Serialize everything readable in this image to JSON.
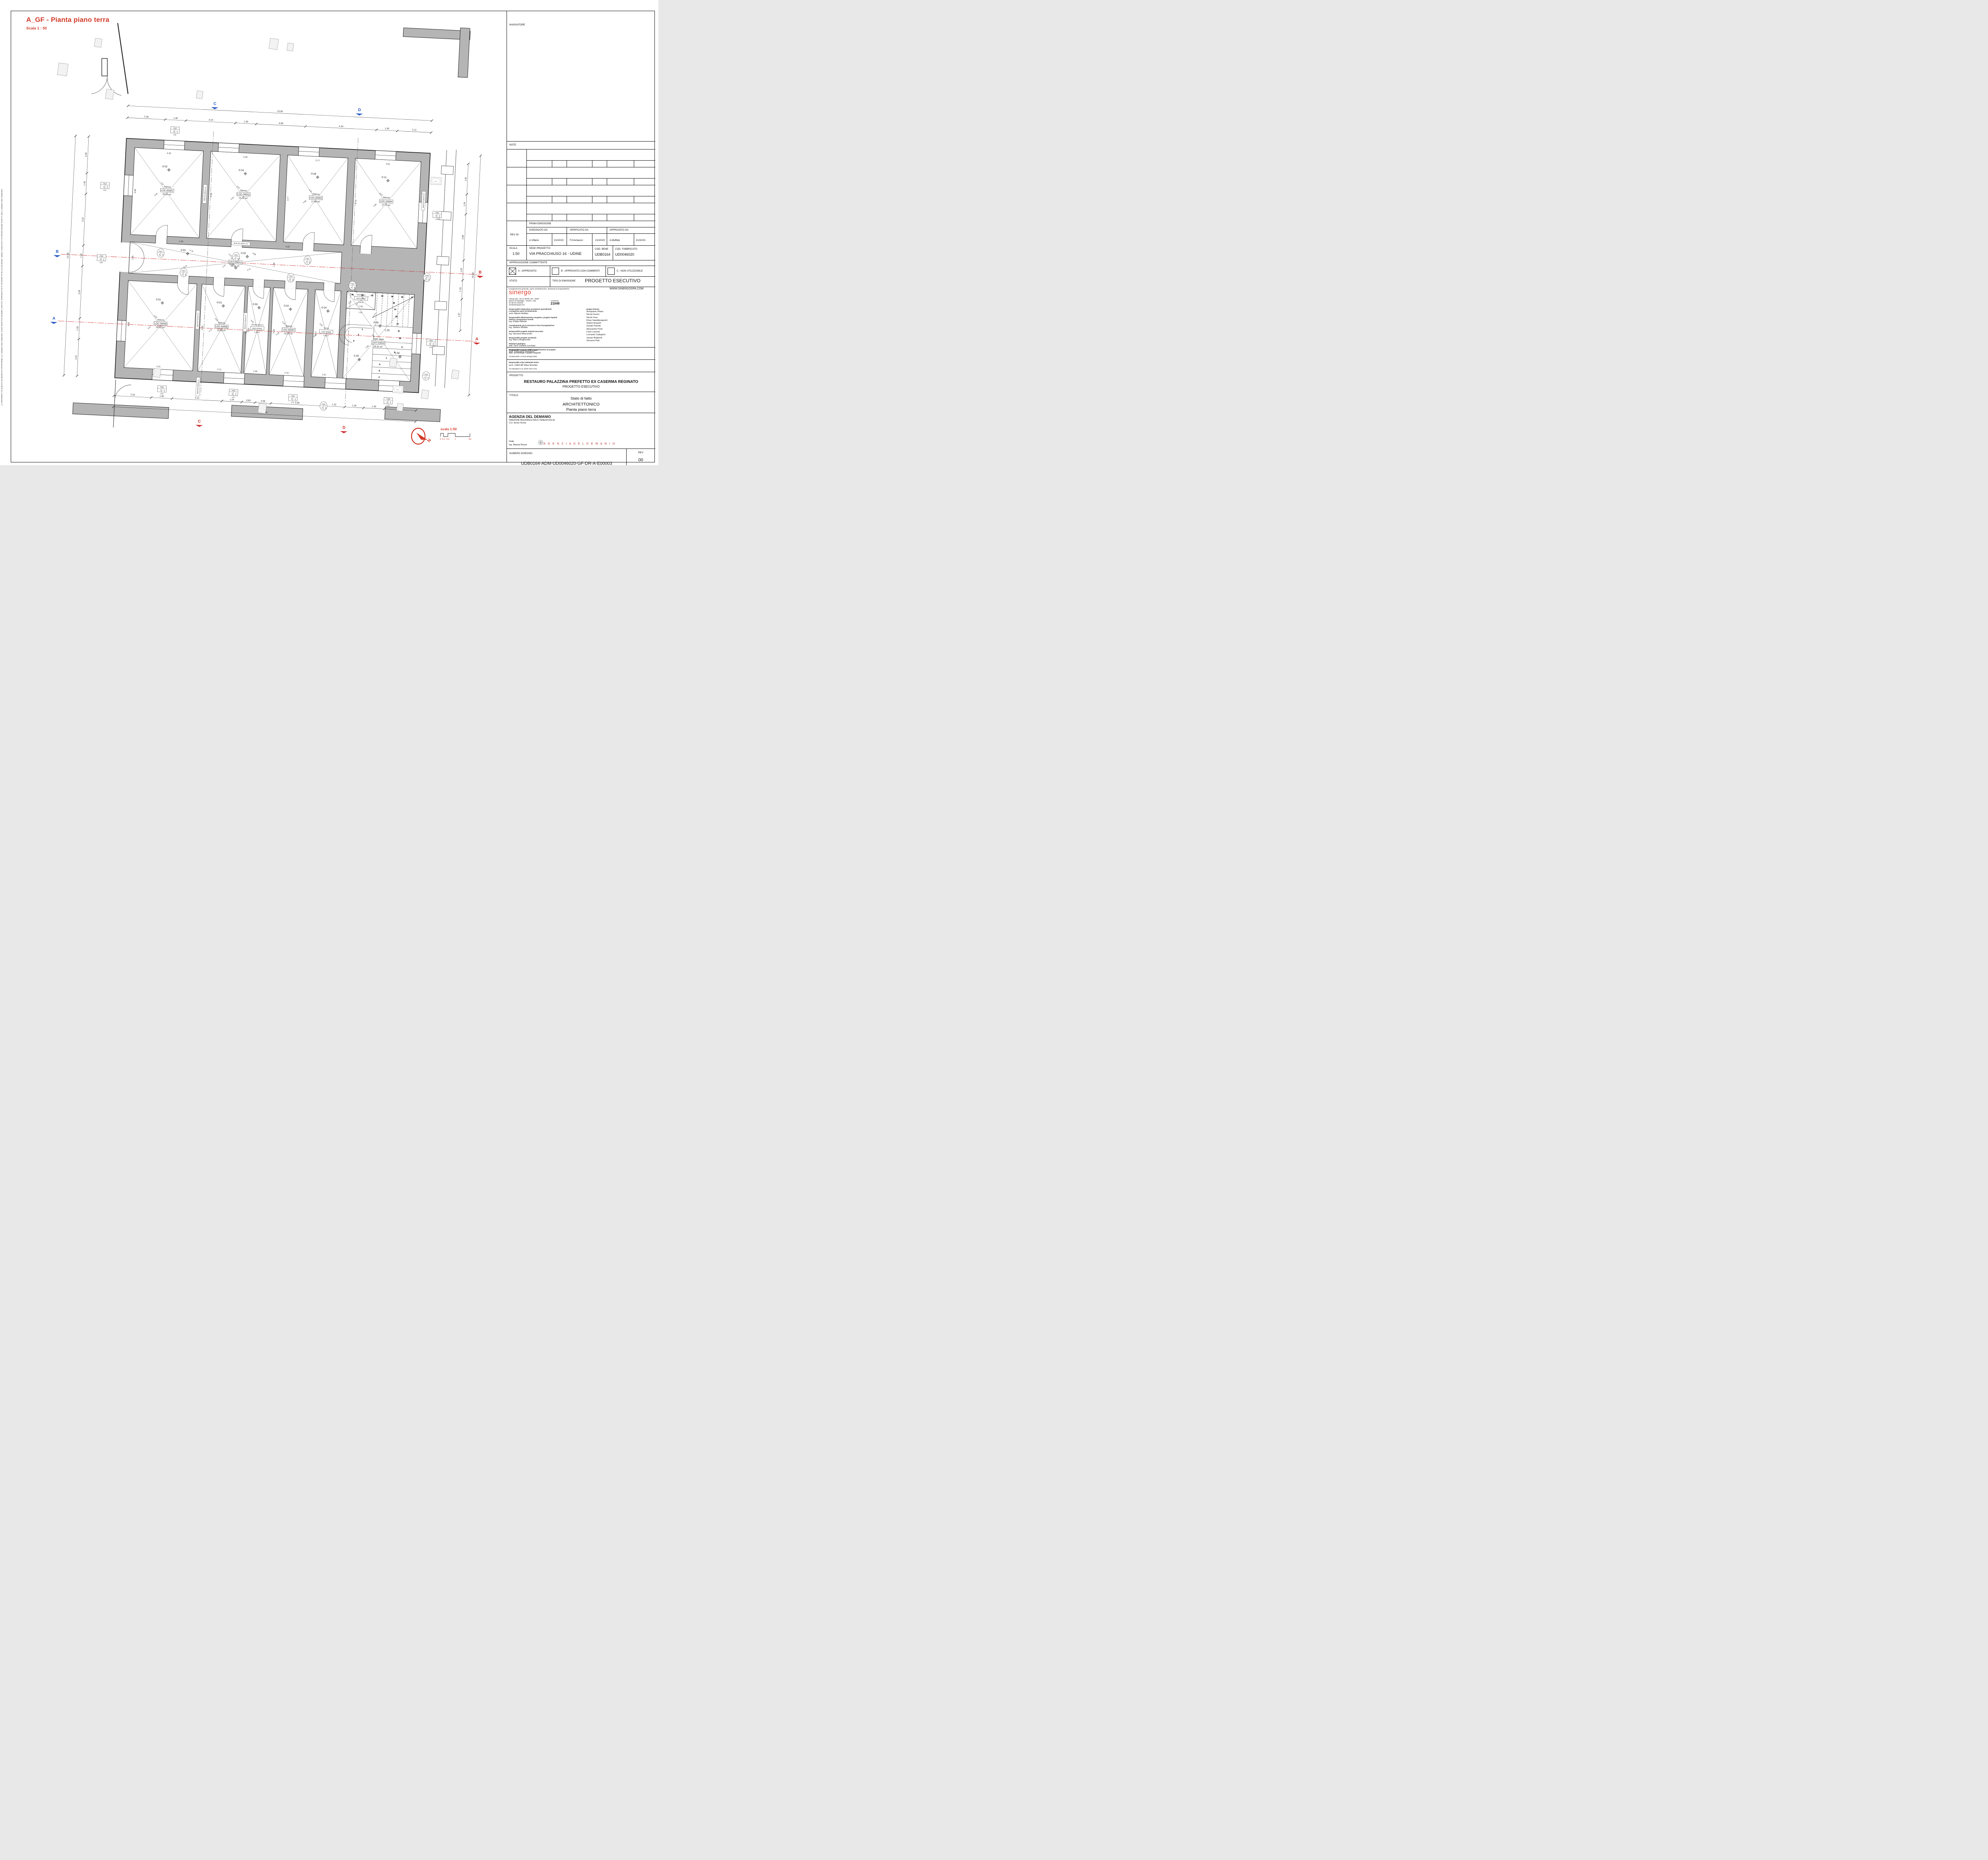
{
  "sheet": {
    "drawing_title": "A_GF - Pianta piano terra",
    "drawing_scale": "Scala  1 : 50",
    "side_disclaimer": "LA PROPRIETÀ DI QUESTO ELABORATO APPARTIENE ALL'AGENZIA DEL DEMANIO. ESSO NON PUÒ ESSERE COPIATO, RIPRODOTTO E TRASFERITO IN ALCUN MODO, SENZA L'ESPLICITA AUTORIZZAZIONE SCRITTA DELL'AGENZIA DEL DEMANIO."
  },
  "titleblock": {
    "navigatore": "NAVIGATORE",
    "note": "NOTE",
    "rev_label": "REV 00",
    "prima_emissione": "PRIMA EMISSIONE",
    "disegnato_da": "DISEGNATO DA",
    "verificato_da": "VERIFICATO DA",
    "approvato_da": "APPROVATO DA",
    "disegnato_nome": "A.Villano",
    "disegnato_data": "21/10/23",
    "verificato_nome": "F.Cremasco",
    "verificato_data": "21/10/23",
    "approvato_nome": "A.Muffato",
    "approvato_data": "21/10/23",
    "scala_label": "SCALA",
    "scala_value": "1:50",
    "sede_label": "SEDE PROGETTO",
    "sede_value": "VIA PRACCHIUSO 16 - UDINE",
    "cod_bene_label": "COD. BENE",
    "cod_bene_value": "UDB0164",
    "cod_fabbricato_label": "COD. FABBRICATO",
    "cod_fabbricato_value": "UD0046020",
    "approvazione": "APPROVAZIONE COMMITTENTE",
    "appr_a": "A - APPROVATO",
    "appr_b": "B - APPROVATO CON COMMENTI",
    "appr_c": "C - NON UTILIZZABILE",
    "stato": "STATO",
    "tipo_emissione": "TIPO DI EMISSIONE",
    "progetto_esecutivo_big": "PROGETTO  ESECUTIVO",
    "coordinamento": "Coordinamento generale, opere architettoniche, strutturali ed impiantistiche",
    "website": "WWW.SINERGOSPA.COM",
    "sinergo": "sinergo",
    "address1": "Sinergo Spa - via Ca' Bembo 152 - 30030",
    "address2": "Maerne di Martellago - Venezia - Italy",
    "address3": "tel+39 041 3642511 -",
    "address4": "info@sinergospa.com",
    "commessa_label": "commessa",
    "commessa_value": "21049",
    "roles": [
      {
        "title": "Responsabile integrazione prestazioni specialistiche\ne progettista opere architettoniche",
        "name": "arch. Alberto Muffato"
      },
      {
        "title": "Responsabile efficientamento energetico, progetto impianti\nelettrici e prevenzione incendi",
        "name": "ing. Filippo Bittante"
      },
      {
        "title": "Coordinamento per la sicurezza in fase di progettazione",
        "name": "ing. Stefano Muffato"
      },
      {
        "title": "Responsabile progetto impianti meccanici",
        "name": "ing. Giovanni Moreschini"
      },
      {
        "title": "Responsabile progetto strutturale",
        "name": "ing. Marco Brugnerotto"
      },
      {
        "title": "Relazione geologica",
        "name": "dott. Geol. Daniele Lucchiari"
      },
      {
        "title": "Responsabile processo BIM e Coordinamento di progetto",
        "name": "arch. Francesca Cremasco"
      }
    ],
    "gruppo_label": "gruppo di lavoro",
    "gruppo": [
      "Annapaola Villano",
      "Nicola Favaro",
      "Nicole Fava",
      "Elnaz Saadatiyeganeh",
      "Shahin Amayeh",
      "Davide Potente",
      "Alessandro Prete",
      "Carlo Laurenti",
      "Leonardo Callegarin",
      "Jacopo Brighenti",
      "Giovanni Palù"
    ],
    "archeo_title": "Responsabile relazione archeologica",
    "archeo_name": "dott. archeologo Claudio Negrelli",
    "archeo_addr": "Via Mancinelli n.4 40141 Bologna (BO)",
    "cam_title": "Responsabile criteri ambientali minimi",
    "cam_name": "arch. LEED AP Elisa Sirombo",
    "cam_addr": "Via Stampatori n.21 10100 Torino (TO)",
    "progetto_label": "PROGETTO",
    "progetto_line1": "RESTAURO PALAZZINA PREFETTO EX CASERMA REGINATO",
    "progetto_line2": "PROGETTO ESECUTIVO",
    "titolo_label": "TITOLO",
    "titolo_line1": "Stato di fatto",
    "titolo_line2": "ARCHITETTONICO",
    "titolo_line3": "Pianta piano terra",
    "agenzia": "AGENZIA DEL DEMANIO",
    "direzione": "DIREZIONE REGIONALE FRIULI VENEZIA GIULIA",
    "uo": "U.O. Servizi Tecnici",
    "rup_label": "r.u.p.",
    "rup_name": "ing. Manuel Rosso",
    "agenzia_brand": "A G E N Z I A   D E L   D E M A N I O",
    "numero_label": "NUMERO DISEGNO",
    "numero_value": "UDB0164-ADM-UD0046020-GF-DR-A-E00003",
    "rev_col_label": "REV",
    "rev_col_value": "00",
    "rev_col_date": "21/10/23"
  },
  "plan": {
    "north_label": "N",
    "scalebar_title": "scala 1:50",
    "scalebar_ticks": [
      "0",
      "0.2",
      "0.5",
      "1",
      "2m"
    ],
    "nc_label": "N.C.",
    "rooms": [
      {
        "id": "LOC-00001",
        "label": "Stanza",
        "code": "LOC-00001",
        "area": "20.81 m²",
        "elev": "-0.02",
        "diag1": "7.03",
        "diag2": "6.40",
        "dim_top": "4.29",
        "dim_side": "4.88"
      },
      {
        "id": "LOC-00002",
        "label": "Stanza",
        "code": "LOC-00002",
        "area": "21.01 m²",
        "elev": "-0.04",
        "diag1": "6.57",
        "diag2": "6.43",
        "dim_top": "4.36",
        "dim_side": "4.86"
      },
      {
        "id": "LOC-00003",
        "label": "Stanza",
        "code": "LOC-00003",
        "area": "17.84 m²",
        "elev": "-0.08",
        "diag1": "6.11",
        "diag2": "5.99",
        "dim_top": "3.77",
        "dim_side": "4.77"
      },
      {
        "id": "LOC-00004",
        "label": "Stanza",
        "code": "LOC-00004",
        "area": "17.72 m²",
        "elev": "-0.11",
        "diag1": "6.07",
        "diag2": "5.96",
        "dim_top": "3.81",
        "dim_side": "4.70"
      },
      {
        "id": "DST-00001",
        "label": "Corridoio",
        "code": "DST-00001",
        "area": "26.51 m²",
        "elev": "0.00",
        "elev2": "-0.02",
        "diag1": "4.70",
        "diag2": "4.74",
        "diag3": "4.69",
        "diag4": "4.72",
        "dim_a": "4.30",
        "dim_b": "4.28",
        "dim_h": "1.96"
      },
      {
        "id": "LOC-00005",
        "label": "Stanza",
        "code": "LOC-00005",
        "area": "20.91 m²",
        "elev": "0.01",
        "diag1": "6.50",
        "diag2": "6.47",
        "dim_top": "4.31",
        "dim_side": "4.88"
      },
      {
        "id": "LOC-00006",
        "label": "Stanza",
        "code": "LOC-00006",
        "area": "13.63 m²",
        "elev": "-0.01",
        "diag1": "5.51",
        "diag2": "5.73",
        "dim_top": "2.71",
        "dim_side": "4.80"
      },
      {
        "id": "WGS-00001",
        "label": "Servizio Igienico",
        "code": "WGS-00001",
        "area": "4.15 m²",
        "elev": "0.00",
        "diag1": "3.32",
        "diag2": "3.32",
        "dim_top": "1.38",
        "dim_side": "3.03"
      },
      {
        "id": "LOC-00007",
        "label": "Stanza",
        "code": "LOC-00007",
        "area": "10.24 m²",
        "elev": "-0.02",
        "diag1": "5.18",
        "diag2": "5.18",
        "dim_top": "2.16",
        "dim_side": "4.68"
      },
      {
        "id": "LOC-00008",
        "label": "Stanza",
        "code": "LOC-00008",
        "area": "7.43 m²",
        "elev": "-0.04",
        "diag1": "4.93",
        "diag2": "4.92",
        "dim_top": "1.61",
        "dim_side": "4.67"
      },
      {
        "id": "DST-00002",
        "label": "Disimpegno",
        "code": "DST-00002",
        "area": "2.08 m²",
        "diag1": "2.05",
        "diag2": "2.04",
        "dim_top": "1.36"
      },
      {
        "id": "DST-00003",
        "label": "Vano scale",
        "code": "DST-00003",
        "area": "16.41 m²",
        "elev": "-0.05",
        "elev2": "0.45",
        "elev3": "1.09",
        "diag1": "5.89",
        "diag2": "5.89",
        "dim_stair": "1.29"
      }
    ],
    "dims": {
      "top_total": "19.00",
      "top_segments": [
        "2.36",
        "1.30",
        "3.10",
        "1.30",
        "3.08",
        "4.44",
        "1.30",
        "2.12"
      ],
      "bottom_total": "18.90",
      "bottom_segments": [
        "2.34",
        "1.30",
        "3.12",
        "1.24",
        "0.83",
        "0.99",
        "3.30",
        "1.32",
        "1.18",
        "1.30",
        "1.99"
      ],
      "left_total": "14.98",
      "left_segments": [
        "2.29",
        "1.30",
        "3.22",
        "1.30",
        "3.26",
        "1.30",
        "2.31"
      ],
      "right_total": "19.28",
      "right_segments": [
        "1.91",
        "1.24",
        "2.89",
        "1.24",
        "1.19",
        "1.97"
      ]
    },
    "section_markers": {
      "a": "A",
      "b": "B",
      "c": "C",
      "d": "D"
    },
    "wall_tags": [
      "MUR-INT-360mm-16",
      "MUR-INT-460mm-18",
      "MUR-INT-310mm-15",
      "MUR-INT-190mm-14",
      "MUR-EST-550mm-08",
      "MUR-EST-660mm-11"
    ],
    "door_tags": [
      {
        "code": "P001",
        "w": "110",
        "h": "235"
      },
      {
        "code": "P005",
        "w": "80",
        "h": "235"
      },
      {
        "code": "P008",
        "w": "135",
        "h": "310"
      },
      {
        "code": "P009",
        "w": "130",
        "h": "310"
      },
      {
        "code": "P010",
        "w": "107",
        "h": "175"
      }
    ],
    "window_tags": [
      {
        "code": "F001",
        "w": "130",
        "h": "210",
        "sill": "0.95"
      },
      {
        "code": "F002",
        "w": "130",
        "h": "210",
        "sill": "0.96"
      },
      {
        "code": "F003",
        "w": "130",
        "h": "210",
        "sill": "0.92"
      },
      {
        "code": "F005",
        "w": "125",
        "h": "220",
        "sill": "0.93"
      },
      {
        "code": "F008",
        "w": "130",
        "h": "220",
        "sill": "0.93"
      },
      {
        "code": "F010",
        "w": "105",
        "h": "215",
        "sill": "0.91"
      }
    ],
    "stair_numbers": [
      "1",
      "2",
      "3",
      "4",
      "5",
      "6",
      "7",
      "8",
      "9",
      "10",
      "11",
      "12",
      "13",
      "14",
      "15",
      "17",
      "18",
      "19",
      "20",
      "21",
      "22",
      "23"
    ],
    "colors": {
      "wall_poche": "#b5b5b5",
      "accent_red": "#d23a28",
      "marker_blue": "#2457c5",
      "section_red": "#cc2a2a"
    }
  }
}
